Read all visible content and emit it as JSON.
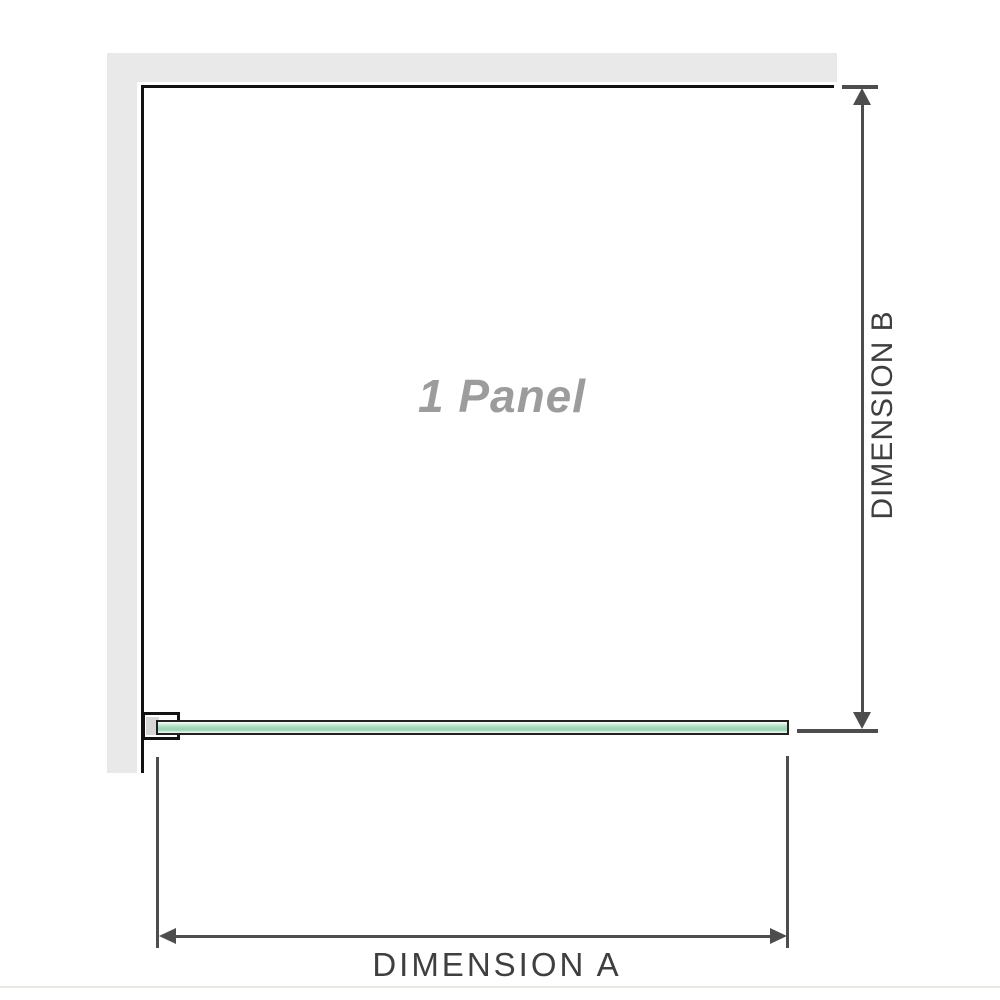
{
  "figure": {
    "watermark": "1 Panel",
    "dimensions": {
      "horizontal": {
        "label": "DIMENSION A"
      },
      "vertical": {
        "label": "DIMENSION B"
      }
    }
  },
  "colors": {
    "wall_fill": "#e9e9e9",
    "structure_line": "#121212",
    "dimension_line": "#4d4d4d",
    "label_text": "#3f3f3f",
    "watermark_text": "#9c9c9c",
    "glass_border": "#202020",
    "glass_fill_mid": "#a4d7ba",
    "glass_fill_light": "#eaf7ef",
    "bracket_pad": "#d6d6d6",
    "bottom_rule": "#e9e9e4"
  }
}
